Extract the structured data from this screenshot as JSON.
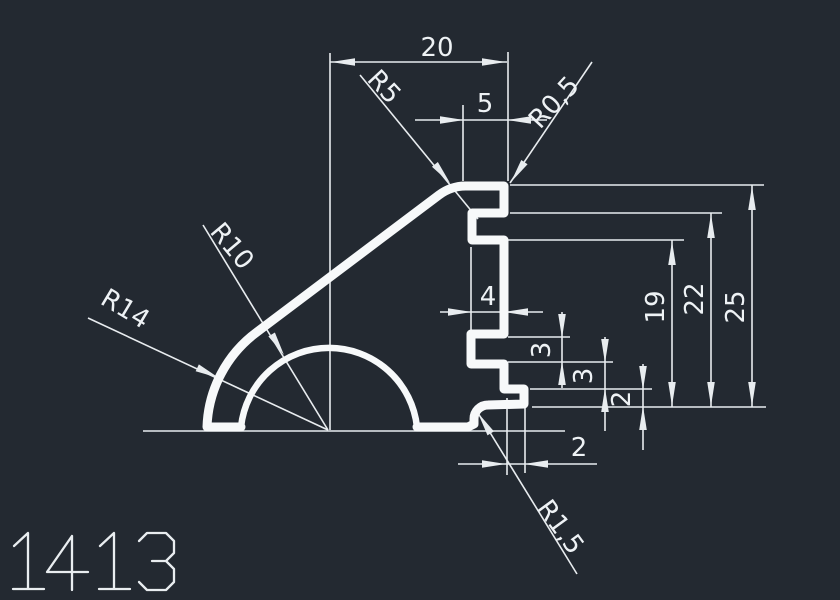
{
  "part_number": "1413",
  "colors": {
    "background": "#232931",
    "line": "#e8ecef",
    "profile": "#f7f9fa",
    "text": "#eef2f5"
  },
  "dims": {
    "overall_width": "20",
    "top_face": "5",
    "groove_depth": "4",
    "spacing_upper": "3",
    "spacing_lower": "3",
    "lip_height": "2",
    "lip_width": "2",
    "height_groove_bottom": "19",
    "height_groove_top": "22",
    "overall_height": "25"
  },
  "radii": {
    "top_corner": "R5",
    "top_edge": "R0,5",
    "inner_dome": "R10",
    "outer_wall": "R14",
    "bottom_fillet": "R1,5"
  }
}
